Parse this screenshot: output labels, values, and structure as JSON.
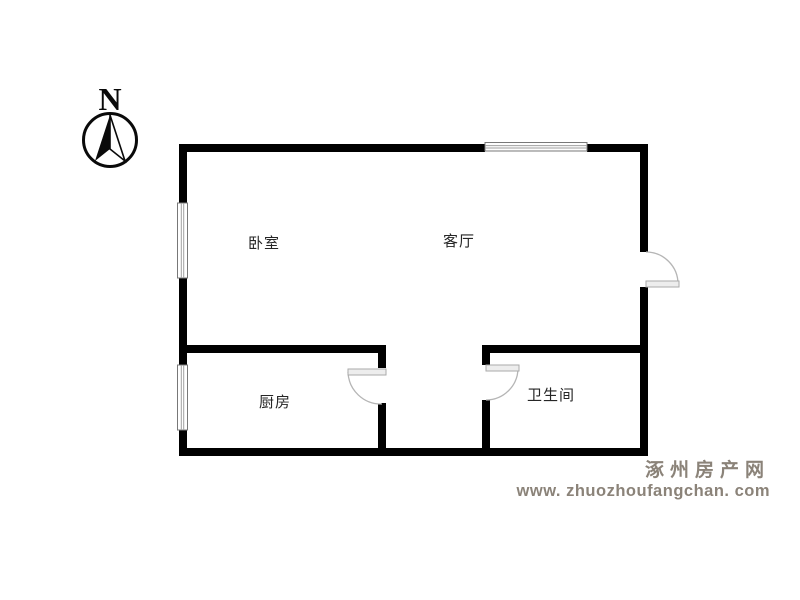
{
  "compass": {
    "label": "N"
  },
  "rooms": [
    {
      "id": "bedroom",
      "label": "卧室"
    },
    {
      "id": "living",
      "label": "客厅"
    },
    {
      "id": "kitchen",
      "label": "厨房"
    },
    {
      "id": "bathroom",
      "label": "卫生间"
    }
  ],
  "watermark": {
    "site_name": "涿州房产网",
    "site_url": "www. zhuozhoufangchan. com"
  },
  "colors": {
    "wall": "#000000",
    "door_arc": "#b5b5b5",
    "door_panel_fill": "#ededed",
    "door_panel_stroke": "#aaaaaa",
    "window_frame": "#787878",
    "window_inner_line": "#a0a0a0",
    "room_label_text": "#262626",
    "watermark_text": "#8b8379"
  }
}
